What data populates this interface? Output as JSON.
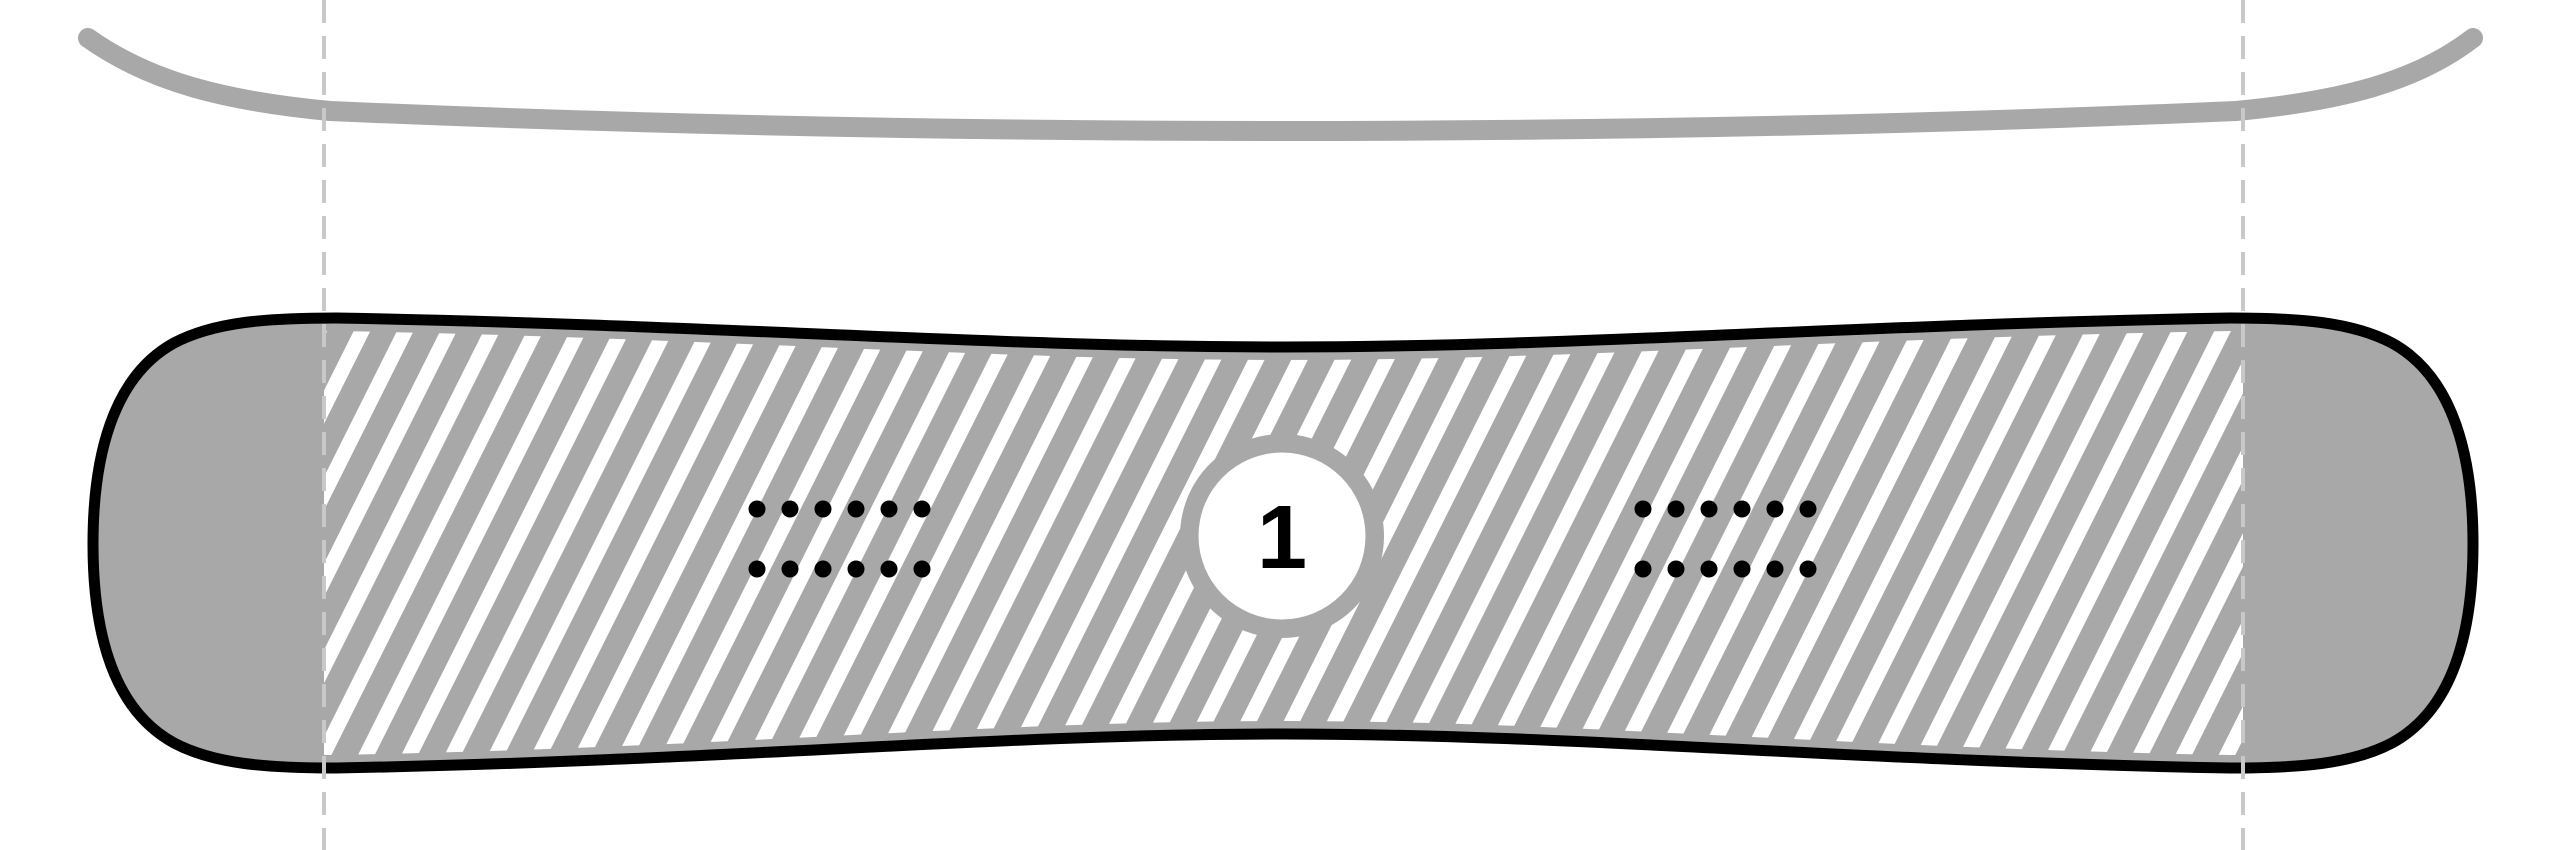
{
  "diagram": {
    "marker": {
      "label": "1"
    },
    "colors": {
      "background": "#ffffff",
      "gray": "#a8a8a8",
      "outline": "#000000",
      "hatch_stripe": "#ffffff",
      "contact_line": "#c8c8c8",
      "marker_fill": "#ffffff",
      "marker_text": "#000000",
      "insert_dot": "#000000"
    },
    "inserts": {
      "groups": 2,
      "rows_per_group": 2,
      "dots_per_row": 6
    }
  }
}
